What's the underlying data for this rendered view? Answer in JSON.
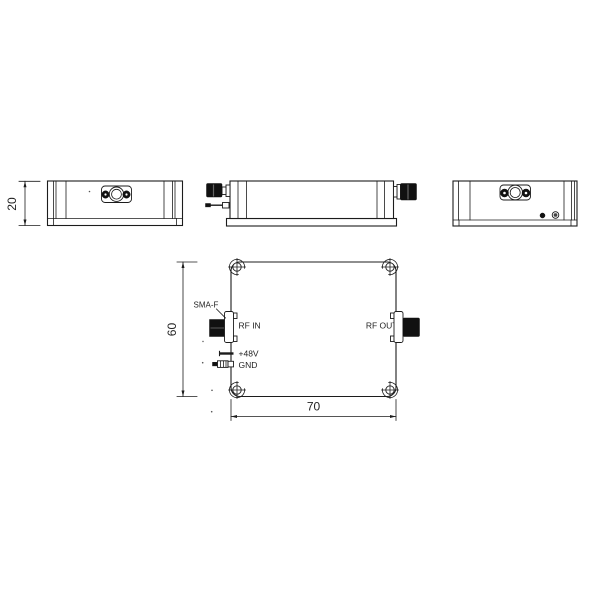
{
  "page": {
    "background": "#ffffff"
  },
  "drawing": {
    "line_color": "#1c1c1c",
    "connector_fill": "#111111",
    "labels": {
      "sma_f": "SMA-F",
      "rf_in": "RF IN",
      "rf_out": "RF OUT",
      "plus48v": "+48V",
      "gnd": "GND"
    },
    "dimensions": {
      "height_mm": "20",
      "width_mm": "60",
      "length_mm": "70"
    }
  }
}
